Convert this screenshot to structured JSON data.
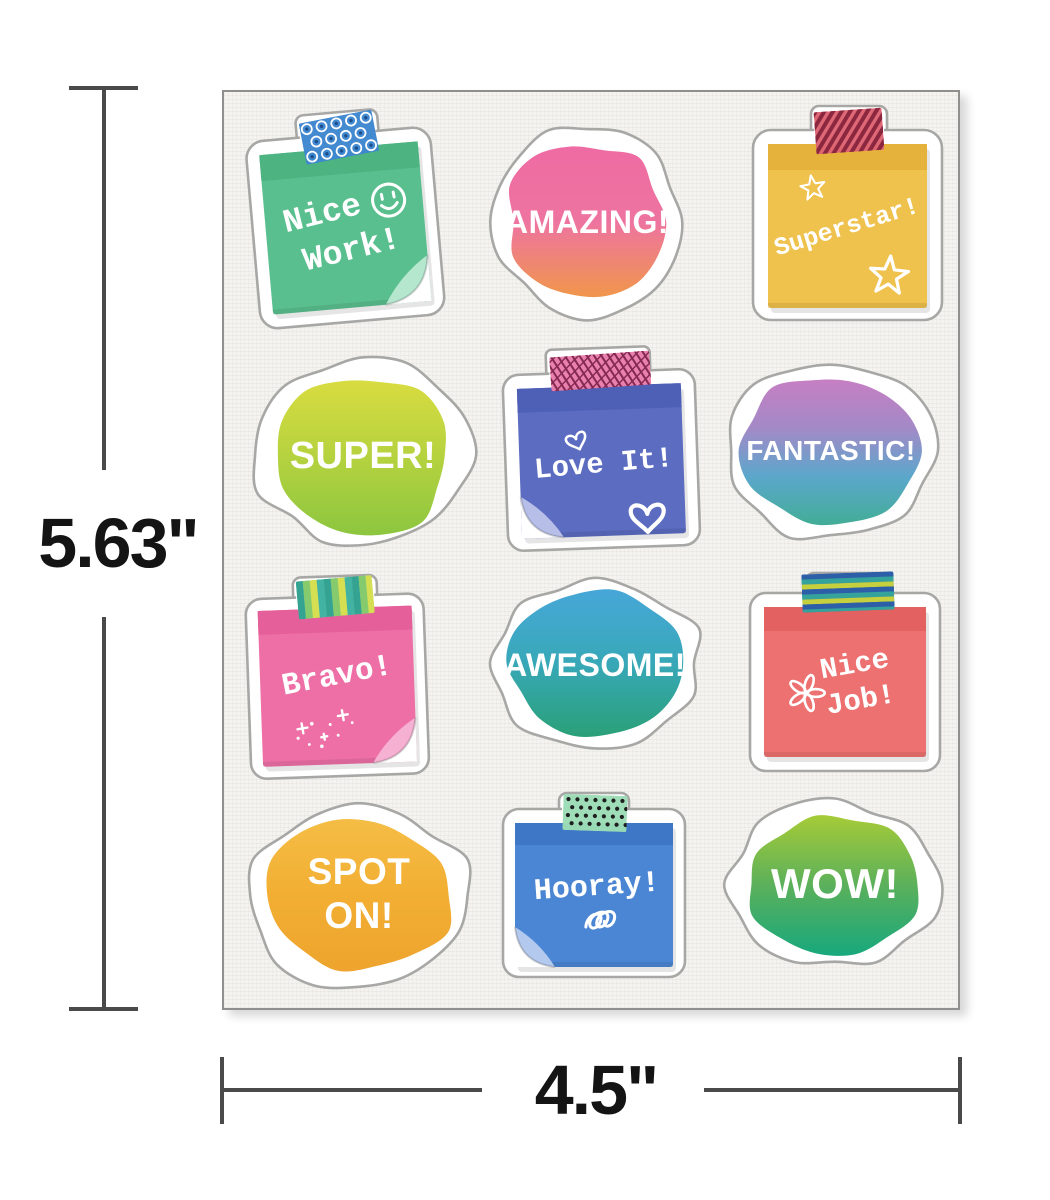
{
  "sheet": {
    "background": "#f4f3f0",
    "border_color": "#8f8f8d"
  },
  "dimensions": {
    "height": {
      "label": "5.63\""
    },
    "width": {
      "label": "4.5\""
    },
    "line_color": "#4a4a4a",
    "label_color": "#141414"
  },
  "stickers": [
    {
      "id": "nice-work",
      "shape": "sticky-note",
      "lines": [
        "Nice",
        "Work!"
      ],
      "doodles": [
        "smiley"
      ],
      "colors": {
        "note": "#5abf8e",
        "band": "#4db381",
        "curl": "#b5e7cf"
      },
      "tape": {
        "pattern": "circles",
        "base": "#3e86cf",
        "pattern_colors": [
          "#ffffff",
          "#1d4e8c"
        ]
      }
    },
    {
      "id": "amazing",
      "shape": "paint-splash",
      "lines": [
        "AMAZING!"
      ],
      "colors": {
        "gradient": [
          "#ee6ba3",
          "#ee74a0",
          "#f0964b"
        ]
      }
    },
    {
      "id": "superstar",
      "shape": "sticky-note",
      "lines": [
        "Superstar!"
      ],
      "doodles": [
        "star",
        "star"
      ],
      "colors": {
        "note": "#efc14d",
        "band": "#e5b23c"
      },
      "tape": {
        "pattern": "diagonal-stripes",
        "base": "#dd6372",
        "pattern_colors": [
          "#8c2740"
        ]
      }
    },
    {
      "id": "super",
      "shape": "paint-splash",
      "lines": [
        "SUPER!"
      ],
      "colors": {
        "gradient": [
          "#d8dc40",
          "#b5d23f",
          "#8cc63f"
        ]
      }
    },
    {
      "id": "love-it",
      "shape": "sticky-note",
      "lines": [
        "Love It!"
      ],
      "doodles": [
        "heart",
        "heart"
      ],
      "colors": {
        "note": "#5b6cc1",
        "band": "#4e5fb6",
        "curl": "#b7bfe9"
      },
      "tape": {
        "pattern": "scribble",
        "base": "#e87cab",
        "pattern_colors": [
          "#84294f"
        ]
      }
    },
    {
      "id": "fantastic",
      "shape": "paint-splash",
      "lines": [
        "FANTASTIC!"
      ],
      "colors": {
        "gradient": [
          "#c67fc3",
          "#a489c7",
          "#5ba7cb",
          "#42ad96"
        ]
      }
    },
    {
      "id": "bravo",
      "shape": "sticky-note",
      "lines": [
        "Bravo!"
      ],
      "doodles": [
        "sparkles"
      ],
      "colors": {
        "note": "#ee6fa6",
        "band": "#e55f9a",
        "curl": "#f6b0d1"
      },
      "tape": {
        "pattern": "vertical-stripes",
        "base": "#79c7b0",
        "pattern_colors": [
          "#35a391",
          "#86ca6e",
          "#d6de52",
          "#42b2a2"
        ]
      }
    },
    {
      "id": "awesome",
      "shape": "paint-splash",
      "lines": [
        "AWESOME!"
      ],
      "colors": {
        "gradient": [
          "#47a7d8",
          "#38a8b8",
          "#2aa077"
        ]
      }
    },
    {
      "id": "nice-job",
      "shape": "sticky-note",
      "lines": [
        "Nice",
        "Job!"
      ],
      "doodles": [
        "flower"
      ],
      "colors": {
        "note": "#ec7170",
        "band": "#e36261"
      },
      "tape": {
        "pattern": "horizontal-stripes",
        "base": "#2d5fa8",
        "pattern_colors": [
          "#2d5fa8",
          "#35a39b",
          "#c6cf3d"
        ]
      }
    },
    {
      "id": "spot-on",
      "shape": "paint-splash",
      "lines": [
        "SPOT",
        "ON!"
      ],
      "colors": {
        "gradient": [
          "#f5bd45",
          "#f2ae33",
          "#eea42e"
        ]
      }
    },
    {
      "id": "hooray",
      "shape": "sticky-note",
      "lines": [
        "Hooray!"
      ],
      "doodles": [
        "squiggle"
      ],
      "colors": {
        "note": "#4a86d3",
        "band": "#3e77c5",
        "curl": "#b3c9ee"
      },
      "tape": {
        "pattern": "dots",
        "base": "#9bdcb6",
        "pattern_colors": [
          "#1f1f1f"
        ]
      }
    },
    {
      "id": "wow",
      "shape": "paint-splash",
      "lines": [
        "WOW!"
      ],
      "colors": {
        "gradient": [
          "#a6cb37",
          "#5bb05b",
          "#17a87d"
        ]
      }
    }
  ]
}
